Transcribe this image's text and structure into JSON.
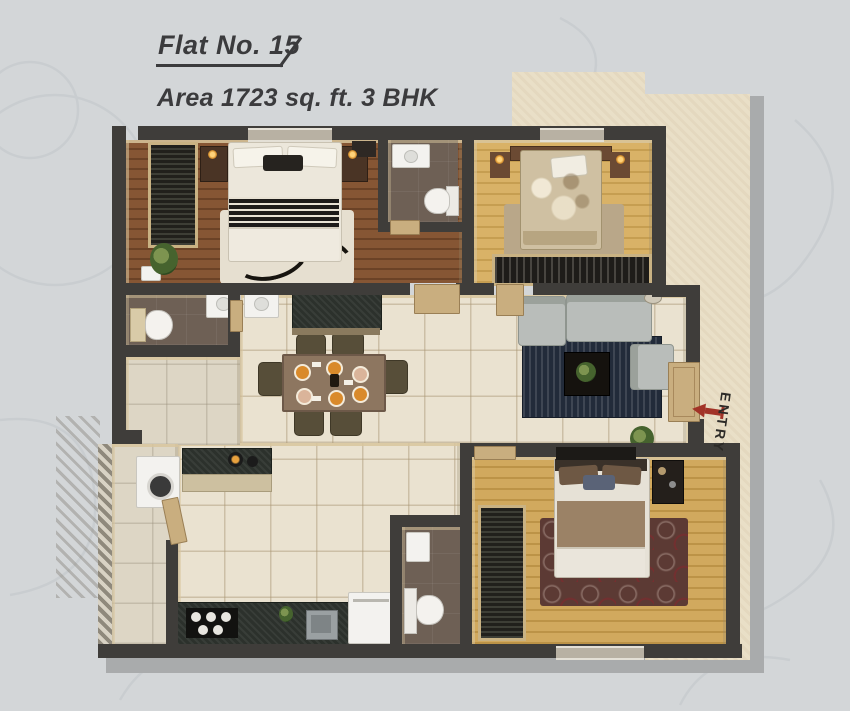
{
  "header": {
    "flat_label": "Flat No. 15",
    "area_label": "Area 1723 sq. ft. 3 BHK"
  },
  "plan": {
    "entry_label": "ENTRY",
    "rooms": [
      {
        "id": "master-bedroom",
        "floor": "wood-dark"
      },
      {
        "id": "master-bathroom",
        "floor": "dark-tile"
      },
      {
        "id": "bedroom-2",
        "floor": "wood-light"
      },
      {
        "id": "common-bathroom",
        "floor": "dark-tile"
      },
      {
        "id": "living-room",
        "floor": "beige-tile"
      },
      {
        "id": "dining-hall",
        "floor": "beige-tile"
      },
      {
        "id": "kitchen",
        "floor": "beige-tile"
      },
      {
        "id": "utility",
        "floor": "gray-tile"
      },
      {
        "id": "bedroom-3",
        "floor": "wood-light"
      },
      {
        "id": "bathroom-3",
        "floor": "dark-tile"
      },
      {
        "id": "entry-corridor",
        "floor": "beige-texture"
      }
    ]
  },
  "palette": {
    "background": "#d3d6d8",
    "swirl_pattern": "#c6cacd",
    "heading_text": "#3b3b3d",
    "wall": "#3f3d3a",
    "tile_floor": "#eae2d0",
    "wood_dark": "#7a4e2e",
    "wood_light": "#d6ae63",
    "bath_floor": "#6e6055",
    "corridor": "#e9dfc7",
    "shadow": "#a9abac",
    "door_tan": "#c9ae7f",
    "sofa_gray": "#b9bdba",
    "rug_navy": "#222b3a",
    "rug_maroon": "#5c3a34",
    "entry_arrow_red": "#a23327"
  }
}
